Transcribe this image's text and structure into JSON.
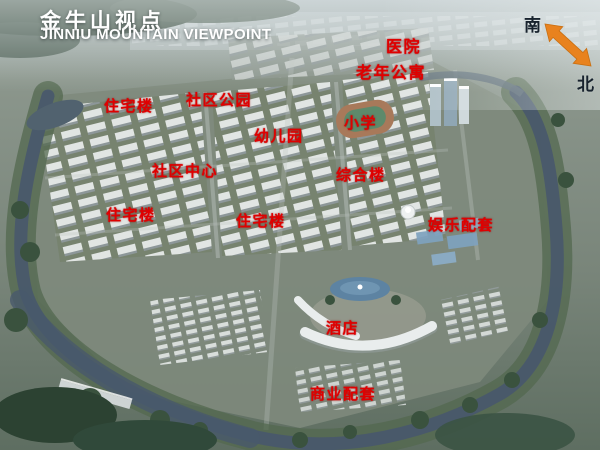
{
  "title": {
    "zh": "金牛山视点",
    "en": "JINNIU MOUNTAIN VIEWPOINT"
  },
  "compass": {
    "south": "南",
    "north": "北",
    "arrow_color": "#e8821e"
  },
  "colors": {
    "label_red": "#e00000",
    "title_white": "#ffffff",
    "water": "#49596b",
    "greenery": "#3a523e"
  },
  "labels": [
    {
      "text": "医院",
      "x": 386,
      "y": 33,
      "fs": 16
    },
    {
      "text": "老年公寓",
      "x": 356,
      "y": 59,
      "fs": 16
    },
    {
      "text": "社区公园",
      "x": 186,
      "y": 89,
      "fs": 15
    },
    {
      "text": "住宅楼",
      "x": 104,
      "y": 95,
      "fs": 15
    },
    {
      "text": "小学",
      "x": 344,
      "y": 112,
      "fs": 15
    },
    {
      "text": "幼儿园",
      "x": 254,
      "y": 125,
      "fs": 15
    },
    {
      "text": "社区中心",
      "x": 152,
      "y": 160,
      "fs": 15
    },
    {
      "text": "综合楼",
      "x": 336,
      "y": 164,
      "fs": 15
    },
    {
      "text": "住宅楼",
      "x": 106,
      "y": 204,
      "fs": 15
    },
    {
      "text": "住宅楼",
      "x": 236,
      "y": 210,
      "fs": 15
    },
    {
      "text": "娱乐配套",
      "x": 428,
      "y": 214,
      "fs": 15
    },
    {
      "text": "酒店",
      "x": 326,
      "y": 317,
      "fs": 15
    },
    {
      "text": "商业配套",
      "x": 310,
      "y": 383,
      "fs": 15
    }
  ]
}
